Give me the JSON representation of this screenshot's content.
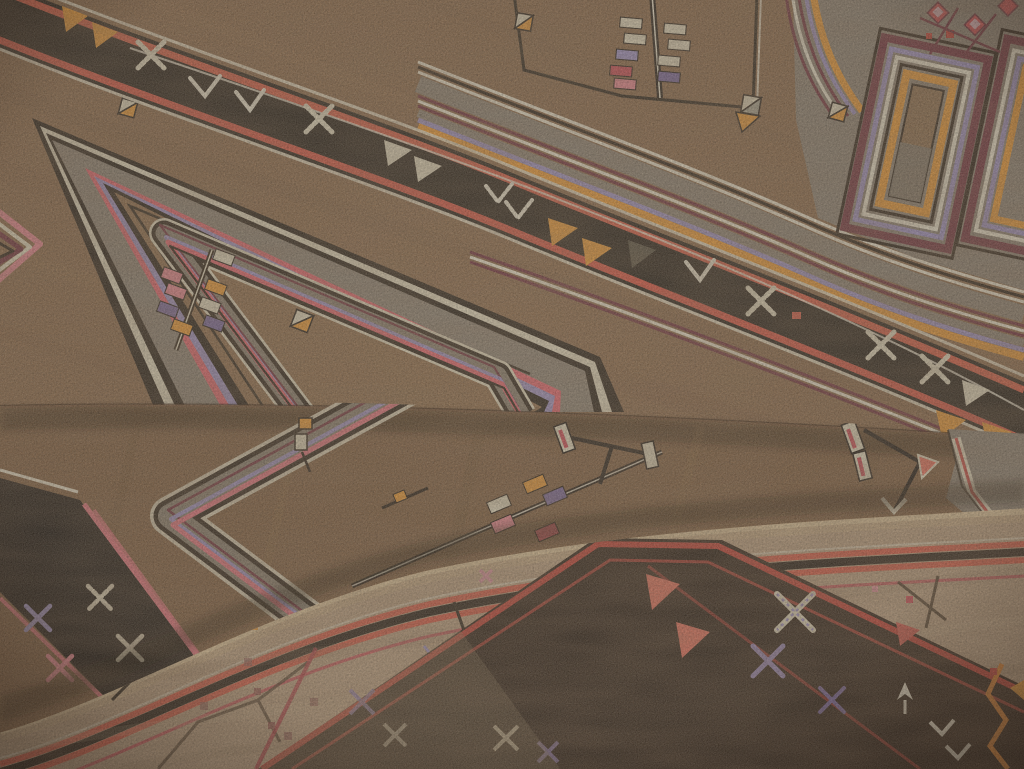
{
  "image": {
    "kind": "photograph",
    "subject": "Overhead close-up of a folded handwoven tribal carpet showing three overlapping folds",
    "style": "Turkish village rug with geometric medallions and motif borders"
  },
  "palette": {
    "field_brown": "#8a6645",
    "field_brown_light": "#a07c52",
    "field_brown_dark": "#6f5136",
    "middle_brown": "#7d5a3a",
    "tan_field": "#bfa282",
    "tan_light": "#dcc098",
    "band_black": "#1f1810",
    "dark_band_brown": "#271a10",
    "grey_panel": "#8b8071",
    "grey_dark": "#6b6253",
    "cream": "#e5dcc0",
    "white_ivory": "#f0e9d3",
    "coral": "#dd5742",
    "coral_bright": "#ef6f5b",
    "red_stripe": "#c43a2f",
    "crimson": "#cf4652",
    "pink": "#e8848e",
    "orange": "#f0992f",
    "maroon": "#6e2c38",
    "maroon_faded": "#93564f",
    "lavender": "#9d90c2",
    "purple": "#75639b"
  },
  "layers": {
    "top_layer": {
      "label": "unfolded top surface of carpet",
      "field_color_ref": "field_brown",
      "border_band": {
        "label": "black diagonal border band",
        "motifs": [
          "orange-triangles",
          "cream-triangles",
          "white-chevrons",
          "dotted-cream-x",
          "grey-half-triangle",
          "cream-flower-x"
        ],
        "edge_stripes": [
          "cream",
          "coral",
          "maroon-white-maroon"
        ]
      },
      "medallions": [
        {
          "label": "large stepped medallion lower left",
          "frame_stripes": [
            "black",
            "cream",
            "grey",
            "pink",
            "lavender",
            "black"
          ],
          "contents": [
            "flag-pole-motif",
            "split-square-motif"
          ]
        },
        {
          "label": "small medallion with flag pole, top center",
          "contents": [
            "pole",
            "cream-flags",
            "lavender-flags",
            "crimson-flags",
            "split-corner-squares"
          ]
        },
        {
          "label": "hook medallion top right",
          "frame_stripes": [
            "black",
            "maroon",
            "lavender",
            "white",
            "orange"
          ],
          "contents": [
            "red-diamonds",
            "maroon-lattice"
          ]
        },
        {
          "label": "partial striped medallion at left edge",
          "frame_stripes": [
            "pink",
            "cream",
            "maroon"
          ]
        }
      ]
    },
    "middle_layer": {
      "label": "first fold of carpet",
      "field_color_ref": "middle_brown",
      "elements": [
        "grey striped chevron band",
        "black corner band with cream and pink X motifs",
        "flag-pole motif with colored pennants",
        "bar-and-arrow motifs",
        "stepped grey panel at right",
        "small orange-dot motif"
      ]
    },
    "bottom_layer": {
      "label": "second fold showing border side",
      "field_color_ref": "tan_field",
      "elements": [
        "bright fold edge",
        "coral-black-coral edge stripes",
        "blossom sprigs",
        "wide dark border band with X motifs and coral triangles",
        "orange zigzag corner band"
      ]
    }
  },
  "motifs_legend": [
    {
      "name": "x-motif",
      "desc": "crossed diagonal bars"
    },
    {
      "name": "flag-pole-motif",
      "desc": "pole with small rectangular pennants"
    },
    {
      "name": "split-square-motif",
      "desc": "square halved diagonally in cream and orange"
    },
    {
      "name": "triangle-motif",
      "desc": "solid triangle pennant"
    },
    {
      "name": "blossom-sprig",
      "desc": "angular stem with small square blossoms"
    },
    {
      "name": "zigzag-motif",
      "desc": "running zigzag line"
    }
  ]
}
